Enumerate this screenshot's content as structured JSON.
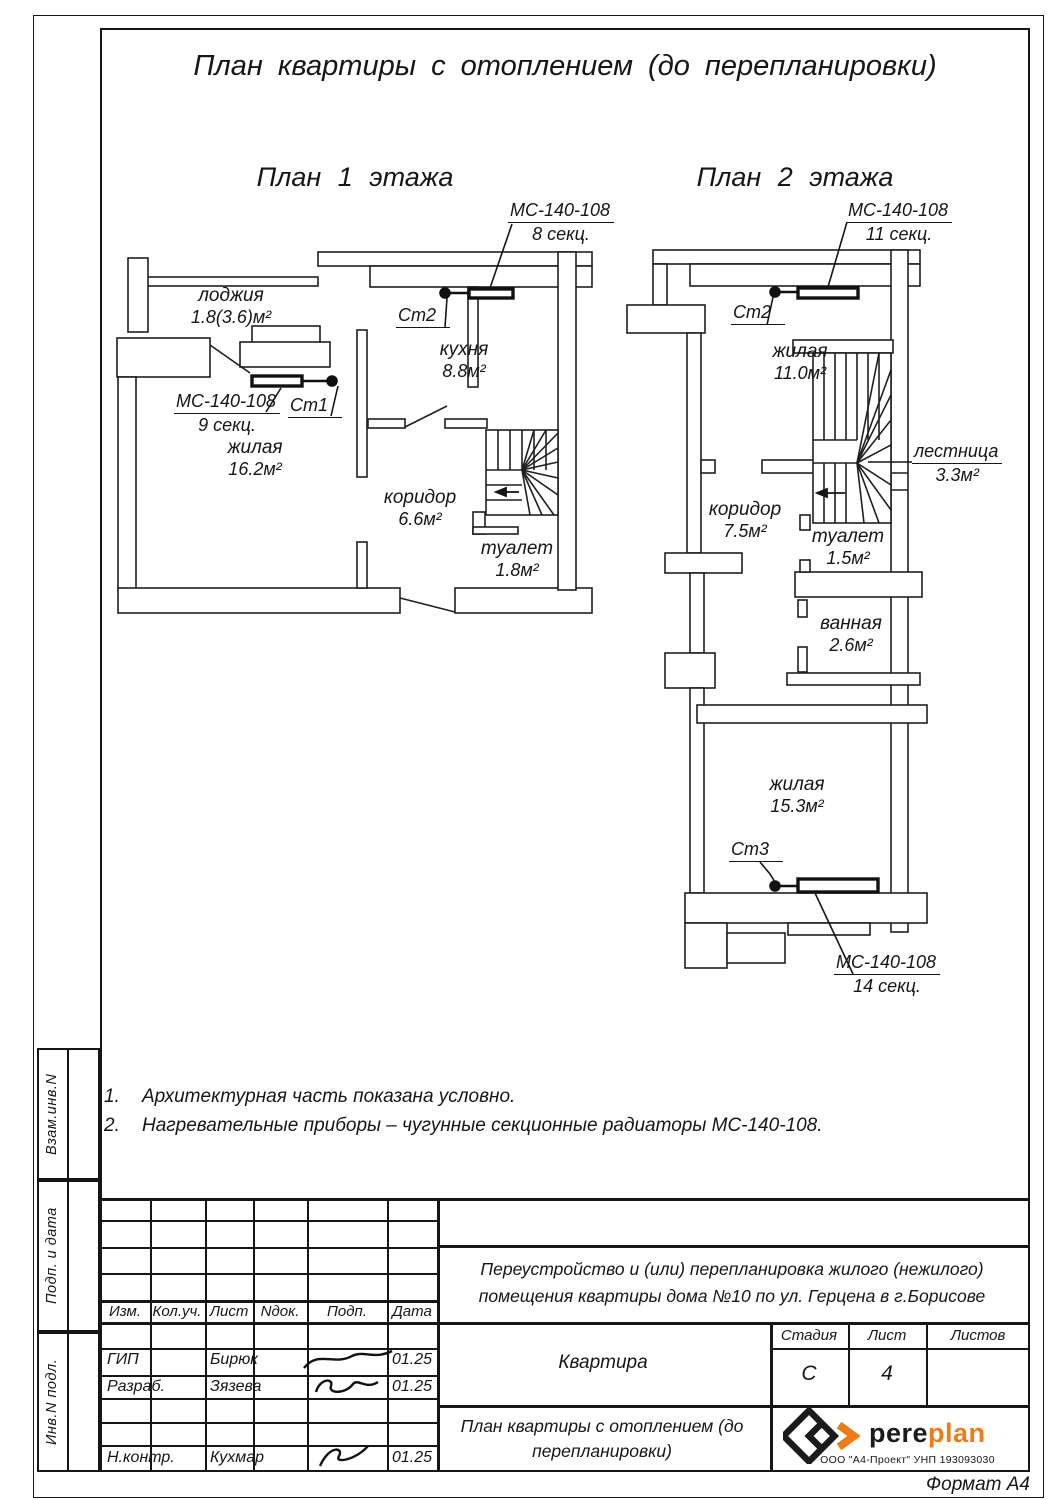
{
  "page": {
    "title": "План квартиры с отоплением (до перепланировки)",
    "format": "Формат А4"
  },
  "plans": [
    {
      "title": "План 1 этажа",
      "rooms": [
        {
          "name": "лоджия",
          "area": "1.8(3.6)м²"
        },
        {
          "name": "кухня",
          "area": "8.8м²"
        },
        {
          "name": "жилая",
          "area": "16.2м²"
        },
        {
          "name": "коридор",
          "area": "6.6м²"
        },
        {
          "name": "туалет",
          "area": "1.8м²"
        }
      ],
      "heat": [
        {
          "model": "МС-140-108",
          "sections": "9 секц.",
          "riser": "Ст1"
        },
        {
          "model": "МС-140-108",
          "sections": "8 секц.",
          "riser": "Ст2"
        }
      ]
    },
    {
      "title": "План 2 этажа",
      "rooms": [
        {
          "name": "жилая",
          "area": "11.0м²"
        },
        {
          "name": "лестница",
          "area": "3.3м²"
        },
        {
          "name": "коридор",
          "area": "7.5м²"
        },
        {
          "name": "туалет",
          "area": "1.5м²"
        },
        {
          "name": "ванная",
          "area": "2.6м²"
        },
        {
          "name": "жилая",
          "area": "15.3м²"
        }
      ],
      "heat": [
        {
          "model": "МС-140-108",
          "sections": "11 секц.",
          "riser": "Ст2"
        },
        {
          "model": "МС-140-108",
          "sections": "14 секц.",
          "riser": "Ст3"
        }
      ]
    }
  ],
  "notes": [
    {
      "num": "1.",
      "text": "Архитектурная часть показана условно."
    },
    {
      "num": "2.",
      "text": "Нагревательные приборы – чугунные секционные радиаторы МС-140-108."
    }
  ],
  "stamp": {
    "cols": [
      "Изм.",
      "Кол.уч.",
      "Лист",
      "Nдок.",
      "Подп.",
      "Дата"
    ],
    "rows": [
      {
        "role": "ГИП",
        "name": "Бирюк",
        "date": "01.25"
      },
      {
        "role": "Разраб.",
        "name": "Зязева",
        "date": "01.25"
      },
      {
        "role": "Н.контр.",
        "name": "Кухмар",
        "date": "01.25"
      }
    ],
    "project": "Переустройство и (или) перепланировка жилого (нежилого) помещения квартиры дома №10 по ул. Герцена в г.Борисове",
    "object": "Квартира",
    "doc_title": "План квартиры с отоплением (до перепланировки)",
    "stage_label": "Стадия",
    "sheet_label": "Лист",
    "sheets_label": "Листов",
    "stage": "С",
    "sheet": "4",
    "sheets": "",
    "brand_black": "pere",
    "brand_orange": "plan",
    "company": "ООО \"А4-Проект\" УНП 193093030",
    "accent": "#ee7d17"
  },
  "sidebar": [
    "Взам.инв.N",
    "Подп. и дата",
    "Инв.N подл."
  ]
}
